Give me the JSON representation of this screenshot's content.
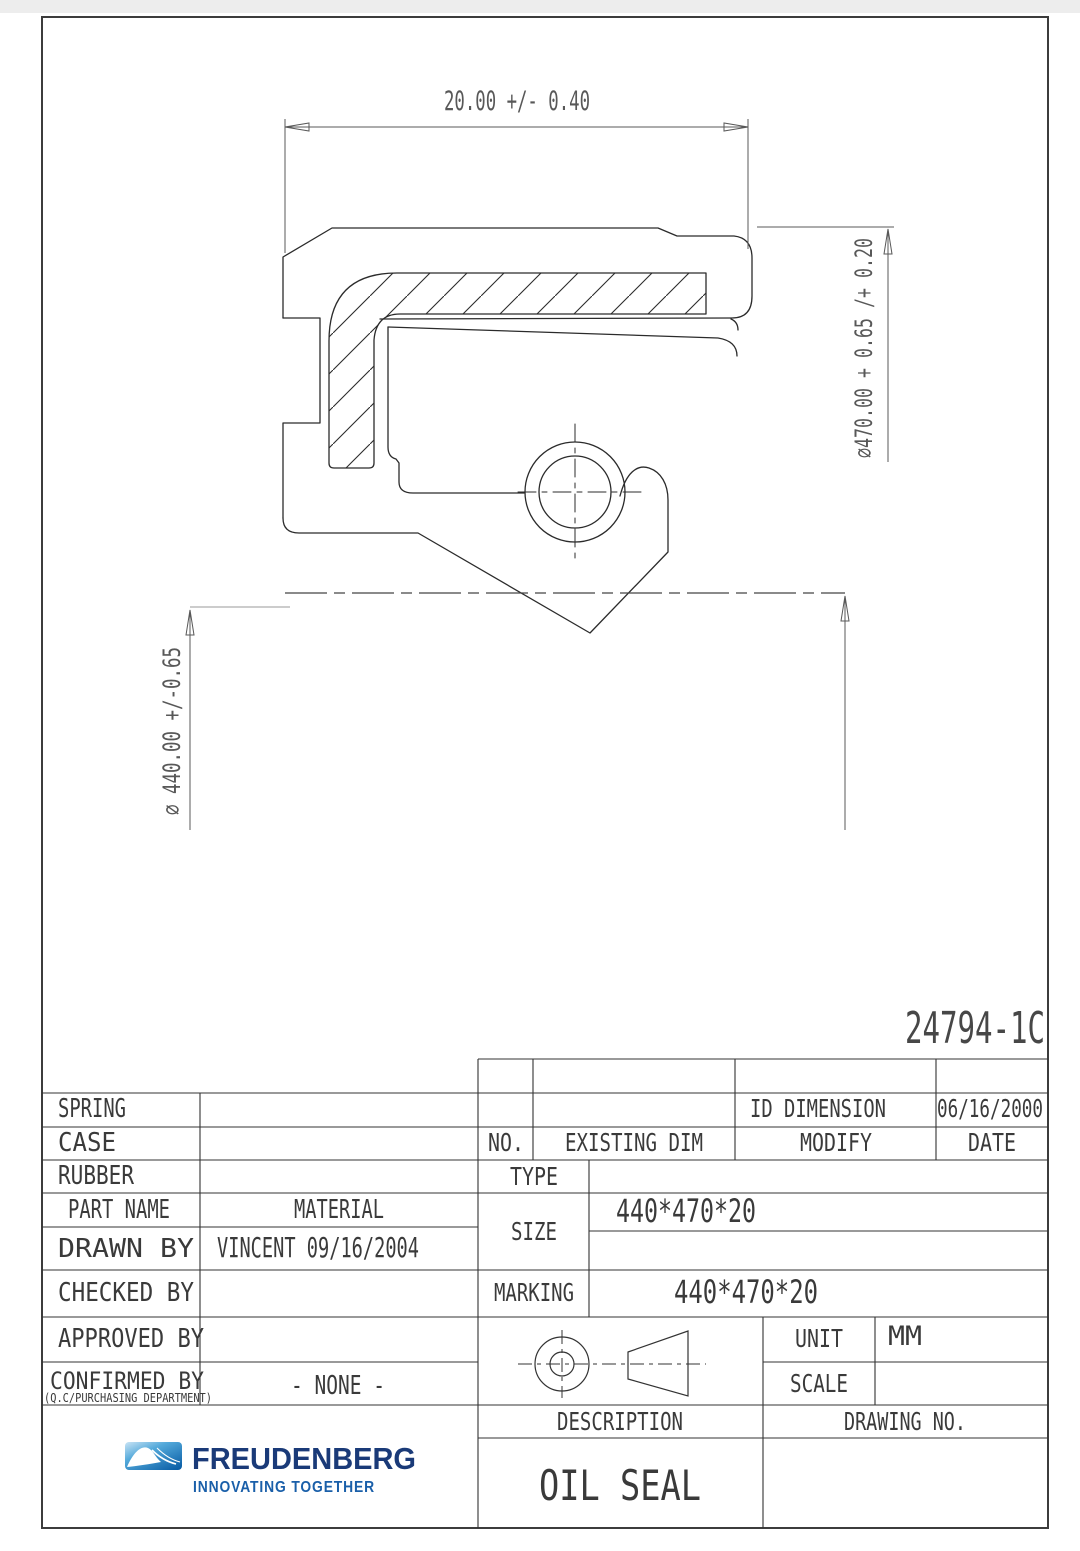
{
  "page": {
    "sheet_number": "24794-1C"
  },
  "dimensions": {
    "width": "20.00 +/- 0.40",
    "outer_diameter": "⌀470.00  + 0.65 /+ 0.20",
    "inner_diameter": "⌀ 440.00 +/-0.65"
  },
  "title_block": {
    "spring_label": "SPRING",
    "case_label": "CASE",
    "rubber_label": "RUBBER",
    "part_name_label": "PART NAME",
    "material_label": "MATERIAL",
    "drawn_by_label": "DRAWN  BY",
    "drawn_by_value": "VINCENT 09/16/2004",
    "checked_by_label": "CHECKED  BY",
    "approved_by_label": "APPROVED BY",
    "confirmed_by_label": "CONFIRMED BY",
    "confirmed_by_note": "(Q.C/PURCHASING DEPARTMENT)",
    "confirmed_by_value": "- NONE -",
    "rev_no_label": "NO.",
    "rev_existing_label": "EXISTING DIM",
    "rev_modify_label": "MODIFY",
    "rev_date_label": "DATE",
    "rev_entry_modify": "ID DIMENSION",
    "rev_entry_date": "06/16/2000",
    "type_label": "TYPE",
    "size_label": "SIZE",
    "size_value": "440*470*20",
    "marking_label": "MARKING",
    "marking_value": "440*470*20",
    "unit_label": "UNIT",
    "unit_value": "MM",
    "scale_label": "SCALE",
    "description_label": "DESCRIPTION",
    "drawing_no_label": "DRAWING NO.",
    "description_value": "OIL SEAL"
  },
  "logo": {
    "brand": "FREUDENBERG",
    "tagline": "INNOVATING TOGETHER"
  }
}
